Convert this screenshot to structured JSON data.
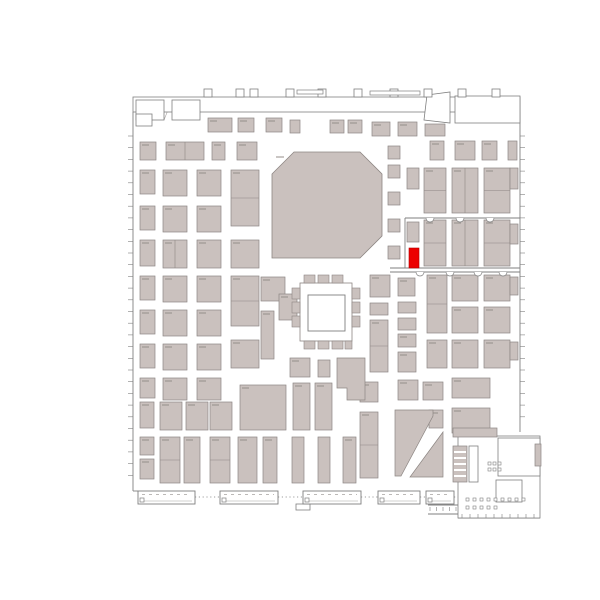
{
  "floor_plan": {
    "name": "exhibition-hall-floor-plan",
    "canvas": {
      "width": 600,
      "height": 600
    },
    "colors": {
      "background": "#ffffff",
      "booth_fill": "#cac1be",
      "booth_stroke": "#8d8683",
      "structure": "#7f7f7f",
      "light": "#a6a2a0",
      "label": "#948e8a",
      "highlight": "#ec0000"
    },
    "highlight_booth": {
      "x": 409,
      "y": 248,
      "w": 10,
      "h": 20
    },
    "octagon": {
      "points": "272,174 294,152 360,152 382,174 382,236 360,258 272,258"
    },
    "courtyard": {
      "outer": [
        300,
        283,
        52,
        58
      ],
      "inner": [
        308,
        295,
        37,
        36
      ]
    },
    "booths": [
      [
        140,
        142,
        16,
        18
      ],
      [
        166,
        142,
        38,
        18,
        1
      ],
      [
        212,
        142,
        13,
        18
      ],
      [
        237,
        142,
        20,
        18
      ],
      [
        140,
        170,
        15,
        24
      ],
      [
        163,
        170,
        24,
        26
      ],
      [
        197,
        170,
        24,
        26
      ],
      [
        231,
        170,
        28,
        56,
        2
      ],
      [
        140,
        206,
        15,
        24
      ],
      [
        163,
        206,
        24,
        26
      ],
      [
        197,
        206,
        24,
        26
      ],
      [
        140,
        240,
        15,
        26
      ],
      [
        163,
        240,
        24,
        28,
        1
      ],
      [
        197,
        240,
        24,
        28
      ],
      [
        231,
        240,
        28,
        28
      ],
      [
        140,
        276,
        15,
        24
      ],
      [
        163,
        276,
        24,
        26
      ],
      [
        197,
        276,
        24,
        26
      ],
      [
        231,
        276,
        28,
        50,
        2
      ],
      [
        140,
        310,
        15,
        24
      ],
      [
        163,
        310,
        24,
        26
      ],
      [
        197,
        310,
        24,
        26
      ],
      [
        140,
        344,
        15,
        24
      ],
      [
        163,
        344,
        24,
        26
      ],
      [
        197,
        344,
        24,
        26
      ],
      [
        231,
        340,
        28,
        28
      ],
      [
        140,
        378,
        15,
        20
      ],
      [
        163,
        378,
        24,
        22
      ],
      [
        197,
        378,
        24,
        22
      ],
      [
        140,
        402,
        14,
        26
      ],
      [
        160,
        402,
        22,
        28
      ],
      [
        186,
        402,
        22,
        28
      ],
      [
        210,
        402,
        22,
        28
      ],
      [
        240,
        385,
        46,
        45
      ],
      [
        140,
        437,
        14,
        18
      ],
      [
        140,
        459,
        14,
        20
      ],
      [
        160,
        437,
        20,
        46,
        2
      ],
      [
        184,
        437,
        16,
        46
      ],
      [
        210,
        437,
        20,
        46,
        2
      ],
      [
        238,
        437,
        19,
        46
      ],
      [
        263,
        437,
        14,
        46
      ],
      [
        292,
        437,
        12,
        46
      ],
      [
        318,
        437,
        12,
        46
      ],
      [
        343,
        437,
        13,
        46
      ],
      [
        388,
        146,
        12,
        13
      ],
      [
        388,
        165,
        12,
        13
      ],
      [
        388,
        192,
        12,
        13
      ],
      [
        388,
        219,
        12,
        13
      ],
      [
        388,
        246,
        12,
        13
      ],
      [
        261,
        277,
        24,
        24
      ],
      [
        261,
        311,
        13,
        48
      ],
      [
        279,
        294,
        18,
        26
      ],
      [
        290,
        358,
        20,
        19
      ],
      [
        318,
        360,
        12,
        17
      ],
      [
        293,
        383,
        17,
        47
      ],
      [
        315,
        383,
        17,
        47
      ],
      [
        208,
        118,
        24,
        14
      ],
      [
        238,
        118,
        16,
        14
      ],
      [
        266,
        118,
        16,
        14
      ],
      [
        290,
        120,
        10,
        13
      ],
      [
        330,
        120,
        14,
        13
      ],
      [
        348,
        120,
        14,
        13
      ],
      [
        372,
        122,
        18,
        14
      ],
      [
        398,
        122,
        19,
        14
      ],
      [
        425,
        124,
        20,
        12
      ],
      [
        430,
        141,
        14,
        19
      ],
      [
        455,
        141,
        20,
        19
      ],
      [
        482,
        141,
        15,
        19
      ],
      [
        508,
        141,
        9,
        19
      ],
      [
        407,
        168,
        12,
        21
      ],
      [
        424,
        168,
        22,
        45,
        2
      ],
      [
        452,
        168,
        26,
        45,
        1
      ],
      [
        484,
        168,
        26,
        45,
        2
      ],
      [
        510,
        168,
        8,
        21
      ],
      [
        407,
        222,
        12,
        20
      ],
      [
        424,
        220,
        22,
        46,
        2
      ],
      [
        452,
        220,
        26,
        46,
        1
      ],
      [
        484,
        220,
        26,
        46,
        2
      ],
      [
        510,
        224,
        8,
        20
      ],
      [
        370,
        275,
        20,
        22
      ],
      [
        398,
        278,
        17,
        18
      ],
      [
        427,
        275,
        20,
        58,
        2
      ],
      [
        452,
        275,
        26,
        26
      ],
      [
        484,
        275,
        26,
        26
      ],
      [
        510,
        277,
        8,
        18
      ],
      [
        370,
        303,
        18,
        12
      ],
      [
        398,
        302,
        18,
        11
      ],
      [
        452,
        307,
        26,
        26
      ],
      [
        484,
        307,
        26,
        26
      ],
      [
        370,
        320,
        18,
        52,
        2
      ],
      [
        398,
        318,
        18,
        12
      ],
      [
        398,
        334,
        18,
        13
      ],
      [
        427,
        340,
        20,
        28
      ],
      [
        452,
        340,
        26,
        28
      ],
      [
        484,
        340,
        26,
        28
      ],
      [
        510,
        342,
        8,
        18
      ],
      [
        398,
        352,
        18,
        20
      ],
      [
        360,
        382,
        18,
        20
      ],
      [
        398,
        380,
        20,
        20
      ],
      [
        423,
        382,
        20,
        18
      ],
      [
        452,
        378,
        38,
        20
      ],
      [
        360,
        412,
        18,
        66,
        2
      ],
      [
        429,
        410,
        14,
        18
      ],
      [
        452,
        408,
        38,
        25
      ],
      [
        453,
        428,
        44,
        9
      ]
    ],
    "ring_booths": [
      [
        304,
        275,
        11,
        8
      ],
      [
        318,
        275,
        11,
        8
      ],
      [
        332,
        275,
        11,
        8
      ],
      [
        304,
        341,
        11,
        8
      ],
      [
        318,
        341,
        11,
        8
      ],
      [
        332,
        341,
        11,
        8
      ],
      [
        345,
        341,
        7,
        8
      ],
      [
        292,
        288,
        8,
        11
      ],
      [
        292,
        302,
        8,
        11
      ],
      [
        292,
        316,
        8,
        11
      ],
      [
        352,
        288,
        8,
        11
      ],
      [
        352,
        302,
        8,
        11
      ],
      [
        352,
        316,
        8,
        11
      ]
    ],
    "booth_polys": [
      "395,410 433,410 433,416 401,476 395,476",
      "443,432 443,477 410,477",
      "337,358 365,358 365,400 347,400 347,388 337,388"
    ],
    "structures": {
      "outline_rects": [
        [
          133,
          97,
          387,
          15
        ],
        [
          136,
          100,
          28,
          20
        ],
        [
          172,
          100,
          28,
          20
        ],
        [
          136,
          114,
          16,
          12
        ],
        [
          455,
          96,
          65,
          27
        ],
        [
          458,
          436,
          82,
          82
        ],
        [
          498,
          438,
          42,
          38
        ],
        [
          496,
          480,
          26,
          22
        ],
        [
          469,
          446,
          9,
          36
        ],
        [
          296,
          504,
          14,
          6
        ]
      ],
      "shaded_rects": [
        [
          453,
          446,
          14,
          36
        ],
        [
          535,
          444,
          6,
          22
        ]
      ],
      "poly_outlines": [
        "427,95 450,92 450,123 424,120"
      ],
      "tabs": [
        [
          204,
          89,
          8,
          8
        ],
        [
          236,
          89,
          8,
          8
        ],
        [
          250,
          89,
          8,
          8
        ],
        [
          286,
          89,
          8,
          8
        ],
        [
          318,
          89,
          8,
          8
        ],
        [
          354,
          89,
          8,
          8
        ],
        [
          390,
          89,
          8,
          8
        ],
        [
          424,
          89,
          8,
          8
        ],
        [
          458,
          89,
          8,
          8
        ],
        [
          492,
          89,
          8,
          8
        ]
      ],
      "bars": [
        [
          297,
          90,
          26,
          4
        ],
        [
          370,
          91,
          50,
          4
        ]
      ],
      "lines": [
        [
          133,
          112,
          133,
          491
        ],
        [
          133,
          491,
          138,
          491
        ],
        [
          520,
          112,
          520,
          432
        ],
        [
          405,
          218,
          405,
          268
        ],
        [
          405,
          218,
          520,
          218
        ],
        [
          390,
          268,
          520,
          268
        ],
        [
          390,
          272,
          520,
          272
        ],
        [
          458,
          518,
          540,
          518
        ],
        [
          428,
          505,
          458,
          505
        ],
        [
          428,
          514,
          458,
          514
        ]
      ],
      "light_lines": [
        [
          162,
          97,
          162,
          112
        ],
        [
          200,
          97,
          200,
          112
        ],
        [
          213,
          97,
          213,
          112
        ],
        [
          238,
          97,
          238,
          112
        ],
        [
          252,
          97,
          252,
          112
        ],
        [
          287,
          97,
          287,
          112
        ],
        [
          300,
          97,
          300,
          112
        ],
        [
          312,
          97,
          312,
          112
        ],
        [
          330,
          97,
          330,
          112
        ],
        [
          352,
          97,
          352,
          112
        ],
        [
          368,
          97,
          368,
          112
        ],
        [
          390,
          97,
          390,
          112
        ],
        [
          405,
          97,
          405,
          112
        ],
        [
          422,
          97,
          422,
          112
        ],
        [
          442,
          97,
          442,
          112
        ],
        [
          458,
          97,
          458,
          112
        ],
        [
          474,
          97,
          474,
          112
        ],
        [
          492,
          97,
          492,
          112
        ],
        [
          506,
          97,
          506,
          112
        ],
        [
          140,
          104,
          160,
          104
        ],
        [
          214,
          105,
          238,
          105
        ],
        [
          253,
          105,
          287,
          105
        ],
        [
          313,
          104,
          330,
          104
        ],
        [
          353,
          105,
          368,
          105
        ],
        [
          391,
          104,
          405,
          104
        ],
        [
          423,
          105,
          442,
          105
        ],
        [
          459,
          104,
          474,
          104
        ],
        [
          493,
          105,
          506,
          105
        ],
        [
          164,
          120,
          172,
          100
        ],
        [
          455,
          104,
          520,
          104
        ],
        [
          455,
          112,
          520,
          112
        ],
        [
          470,
          96,
          470,
          104
        ],
        [
          485,
          96,
          485,
          104
        ],
        [
          500,
          96,
          500,
          104
        ],
        [
          458,
          478,
          482,
          478
        ],
        [
          482,
          478,
          482,
          505
        ],
        [
          510,
          438,
          510,
          452
        ],
        [
          522,
          438,
          522,
          452
        ],
        [
          532,
          438,
          532,
          452
        ],
        [
          498,
          452,
          540,
          452
        ],
        [
          516,
          452,
          516,
          476
        ],
        [
          516,
          464,
          540,
          464
        ],
        [
          528,
          464,
          528,
          476
        ],
        [
          508,
          480,
          508,
          502
        ],
        [
          470,
          452,
          477,
          452
        ],
        [
          470,
          458,
          477,
          458
        ],
        [
          470,
          464,
          477,
          464
        ],
        [
          470,
          470,
          477,
          470
        ],
        [
          470,
          476,
          477,
          476
        ]
      ],
      "white_lines": [
        [
          454,
          452,
          466,
          452
        ],
        [
          454,
          458,
          466,
          458
        ],
        [
          454,
          464,
          466,
          464
        ],
        [
          454,
          470,
          466,
          470
        ],
        [
          454,
          476,
          466,
          476
        ]
      ],
      "modules": [
        [
          138,
          491,
          57,
          13
        ],
        [
          220,
          491,
          58,
          13
        ],
        [
          303,
          491,
          58,
          13
        ],
        [
          378,
          491,
          42,
          13
        ],
        [
          426,
          491,
          28,
          13
        ]
      ],
      "dotted_connectors": [
        [
          195,
          497,
          220,
          497
        ],
        [
          278,
          497,
          303,
          497
        ],
        [
          361,
          497,
          378,
          497
        ],
        [
          420,
          497,
          426,
          497
        ],
        [
          454,
          497,
          458,
          497
        ]
      ],
      "arcs": [
        [
          420,
          272,
          4
        ],
        [
          450,
          272,
          4
        ],
        [
          478,
          272,
          4
        ],
        [
          503,
          272,
          4
        ],
        [
          430,
          218,
          4
        ],
        [
          460,
          218,
          4
        ],
        [
          490,
          218,
          4
        ]
      ],
      "dot_rows": [
        {
          "y": 498,
          "from": 466,
          "to": 522,
          "step": 7
        },
        {
          "y": 506,
          "from": 466,
          "to": 494,
          "step": 7
        },
        {
          "y": 462,
          "from": 488,
          "to": 498,
          "step": 5
        },
        {
          "y": 468,
          "from": 488,
          "to": 498,
          "step": 5
        }
      ],
      "tick_rows": [
        {
          "o": "h",
          "x": 128,
          "len": 5,
          "from": 136,
          "to": 486,
          "step": 11.7
        },
        {
          "o": "h",
          "x": 520,
          "len": 5,
          "from": 136,
          "to": 425,
          "step": 11.7
        },
        {
          "o": "v",
          "y": 514,
          "len": 4,
          "from": 462,
          "to": 538,
          "step": 8
        },
        {
          "o": "v",
          "y": 507,
          "len": 4,
          "from": 430,
          "to": 456,
          "step": 6.5
        }
      ]
    }
  }
}
